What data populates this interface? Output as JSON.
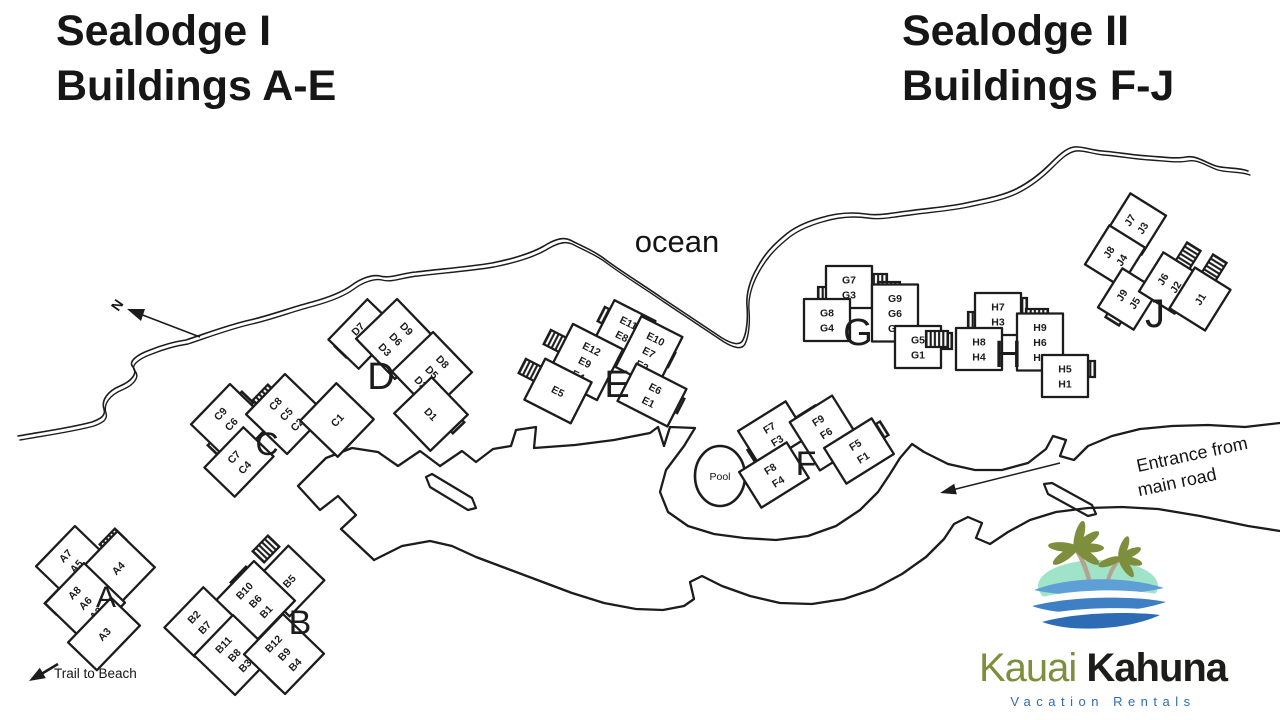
{
  "titles": {
    "left": {
      "line1": "Sealodge I",
      "line2": "Buildings A-E"
    },
    "right": {
      "line1": "Sealodge II",
      "line2": "Buildings F-J"
    }
  },
  "map_labels": {
    "ocean": "ocean",
    "pool": "Pool",
    "north": "N",
    "trail": "Trail to Beach",
    "entrance_line1": "Entrance from",
    "entrance_line2": "main road"
  },
  "logo": {
    "brand_primary": "Kauai",
    "brand_secondary": "Kahuna",
    "tagline": "Vacation Rentals"
  },
  "colors": {
    "ink": "#1c1c1c",
    "logo_green": "#7d8e3c",
    "logo_dark": "#1d1d1b",
    "logo_blue": "#2d6cb5",
    "wave_light": "#5e9fd6",
    "wave_mid": "#3f7fc4",
    "island_mint": "#9fe3c8",
    "trunk": "#b5a38c"
  },
  "map": {
    "buildings": [
      {
        "letter": "A",
        "lx": 106,
        "ly": 607,
        "ls": 30,
        "wings": [
          {
            "x": 76,
            "y": 566,
            "r": -46,
            "labels": [
              "A7",
              "A5",
              "A1"
            ]
          },
          {
            "x": 118,
            "y": 568,
            "r": -46,
            "labels": [
              "A4"
            ],
            "w": 52,
            "h": 52
          },
          {
            "x": 85,
            "y": 603,
            "r": -46,
            "labels": [
              "A8",
              "A6",
              "A2"
            ]
          },
          {
            "x": 104,
            "y": 634,
            "r": -46,
            "labels": [
              "A3"
            ],
            "w": 62,
            "h": 40
          }
        ],
        "stairs": [
          {
            "x": 73,
            "y": 546,
            "r": -46
          },
          {
            "x": 113,
            "y": 542,
            "r": -46
          },
          {
            "x": 58,
            "y": 601,
            "r": -46
          },
          {
            "x": 92,
            "y": 650,
            "r": -46
          }
        ]
      },
      {
        "letter": "B",
        "lx": 300,
        "ly": 634,
        "ls": 34,
        "wings": [
          {
            "x": 289,
            "y": 581,
            "r": -46,
            "labels": [
              "B5"
            ],
            "w": 50,
            "h": 50
          },
          {
            "x": 255,
            "y": 601,
            "r": -46,
            "labels": [
              "B10",
              "B6",
              "B1"
            ]
          },
          {
            "x": 199,
            "y": 622,
            "r": -46,
            "labels": [
              "B2",
              "B7"
            ]
          },
          {
            "x": 234,
            "y": 655,
            "r": -46,
            "labels": [
              "B11",
              "B8",
              "B3"
            ]
          },
          {
            "x": 284,
            "y": 654,
            "r": -46,
            "labels": [
              "B12",
              "B9",
              "B4"
            ]
          }
        ],
        "stairs": [
          {
            "x": 266,
            "y": 549,
            "r": -46
          },
          {
            "x": 244,
            "y": 580,
            "r": -46
          },
          {
            "x": 186,
            "y": 629,
            "r": -46
          },
          {
            "x": 231,
            "y": 674,
            "r": -46
          },
          {
            "x": 281,
            "y": 675,
            "r": -46
          }
        ]
      },
      {
        "letter": "C",
        "lx": 267,
        "ly": 455,
        "ls": 32,
        "wings": [
          {
            "x": 231,
            "y": 424,
            "r": -46,
            "labels": [
              "C9",
              "C6",
              "C3"
            ]
          },
          {
            "x": 286,
            "y": 414,
            "r": -46,
            "labels": [
              "C8",
              "C5",
              "C2"
            ]
          },
          {
            "x": 337,
            "y": 420,
            "r": -46,
            "labels": [
              "C1"
            ],
            "w": 52,
            "h": 52
          },
          {
            "x": 239,
            "y": 462,
            "r": -46,
            "labels": [
              "C7",
              "C4"
            ]
          }
        ],
        "stairs": [
          {
            "x": 240,
            "y": 405,
            "r": -46
          },
          {
            "x": 266,
            "y": 398,
            "r": -46
          },
          {
            "x": 338,
            "y": 403,
            "r": -46
          },
          {
            "x": 221,
            "y": 443,
            "r": -46
          }
        ]
      },
      {
        "letter": "D",
        "lx": 381,
        "ly": 389,
        "ls": 38,
        "wings": [
          {
            "x": 363,
            "y": 334,
            "r": -46,
            "labels": [
              "D7",
              "D4"
            ]
          },
          {
            "x": 396,
            "y": 339,
            "r": 46,
            "labels": [
              "D9",
              "D6",
              "D3"
            ]
          },
          {
            "x": 432,
            "y": 372,
            "r": 46,
            "labels": [
              "D8",
              "D5",
              "D2"
            ]
          },
          {
            "x": 431,
            "y": 414,
            "r": 46,
            "labels": [
              "D1"
            ],
            "w": 52,
            "h": 52
          }
        ],
        "stairs": [
          {
            "x": 348,
            "y": 344,
            "r": -46
          },
          {
            "x": 404,
            "y": 320,
            "r": 46
          },
          {
            "x": 449,
            "y": 364,
            "r": 46
          },
          {
            "x": 451,
            "y": 420,
            "r": 46
          }
        ]
      },
      {
        "letter": "E",
        "lx": 617,
        "ly": 397,
        "ls": 38,
        "wings": [
          {
            "x": 622,
            "y": 336,
            "r": 27,
            "labels": [
              "E11",
              "E8",
              "E3"
            ],
            "w": 46
          },
          {
            "x": 649,
            "y": 352,
            "r": 27,
            "labels": [
              "E10",
              "E7",
              "E2"
            ],
            "w": 46
          },
          {
            "x": 585,
            "y": 362,
            "r": 27,
            "labels": [
              "E12",
              "E9",
              "E4"
            ]
          },
          {
            "x": 558,
            "y": 391,
            "r": 27,
            "labels": [
              "E5"
            ],
            "w": 52,
            "h": 46
          },
          {
            "x": 652,
            "y": 395,
            "r": 27,
            "labels": [
              "E6",
              "E1"
            ]
          }
        ],
        "stairs": [
          {
            "x": 611,
            "y": 319,
            "r": 27
          },
          {
            "x": 557,
            "y": 342,
            "r": 27
          },
          {
            "x": 532,
            "y": 371,
            "r": 27
          },
          {
            "x": 662,
            "y": 355,
            "r": 27
          },
          {
            "x": 671,
            "y": 401,
            "r": 27
          }
        ]
      },
      {
        "letter": "F",
        "lx": 806,
        "ly": 475,
        "ls": 34,
        "wings": [
          {
            "x": 773,
            "y": 434,
            "r": -32,
            "labels": [
              "F7",
              "F3"
            ]
          },
          {
            "x": 826,
            "y": 433,
            "r": -32,
            "labels": [
              "F9",
              "F6",
              "F2"
            ],
            "w": 50
          },
          {
            "x": 859,
            "y": 451,
            "r": -32,
            "labels": [
              "F5",
              "F1"
            ]
          },
          {
            "x": 774,
            "y": 475,
            "r": -32,
            "labels": [
              "F8",
              "F4"
            ]
          }
        ],
        "stairs": [
          {
            "x": 784,
            "y": 420,
            "r": -32
          },
          {
            "x": 810,
            "y": 418,
            "r": -32
          },
          {
            "x": 875,
            "y": 434,
            "r": -32
          },
          {
            "x": 761,
            "y": 451,
            "r": -32
          }
        ]
      },
      {
        "letter": "G",
        "lx": 858,
        "ly": 345,
        "ls": 38,
        "wings": [
          {
            "x": 849,
            "y": 287,
            "r": 0,
            "labels": [
              "G7",
              "G3"
            ],
            "w": 46
          },
          {
            "x": 895,
            "y": 313,
            "r": 0,
            "labels": [
              "G9",
              "G6",
              "G2"
            ],
            "w": 46
          },
          {
            "x": 827,
            "y": 320,
            "r": 0,
            "labels": [
              "G8",
              "G4"
            ],
            "w": 46
          },
          {
            "x": 918,
            "y": 347,
            "r": 0,
            "labels": [
              "G5",
              "G1"
            ],
            "w": 46
          }
        ],
        "stairs": [
          {
            "x": 876,
            "y": 282,
            "r": 0
          },
          {
            "x": 889,
            "y": 290,
            "r": 0
          },
          {
            "x": 829,
            "y": 295,
            "r": 0
          },
          {
            "x": 941,
            "y": 341,
            "r": 0
          }
        ]
      },
      {
        "letter": "H",
        "lx": 1008,
        "ly": 367,
        "ls": 38,
        "wings": [
          {
            "x": 998,
            "y": 314,
            "r": 0,
            "labels": [
              "H7",
              "H3"
            ],
            "w": 46
          },
          {
            "x": 979,
            "y": 349,
            "r": 0,
            "labels": [
              "H8",
              "H4"
            ],
            "w": 46
          },
          {
            "x": 1040,
            "y": 342,
            "r": 0,
            "labels": [
              "H9",
              "H6",
              "H2"
            ],
            "w": 46
          },
          {
            "x": 1065,
            "y": 376,
            "r": 0,
            "labels": [
              "H5",
              "H1"
            ],
            "w": 46
          }
        ],
        "stairs": [
          {
            "x": 1016,
            "y": 306,
            "r": 0
          },
          {
            "x": 979,
            "y": 320,
            "r": 0
          },
          {
            "x": 1037,
            "y": 317,
            "r": 0
          },
          {
            "x": 1084,
            "y": 369,
            "r": 0
          },
          {
            "x": 937,
            "y": 339,
            "r": 0
          }
        ]
      },
      {
        "letter": "J",
        "lx": 1155,
        "ly": 327,
        "ls": 40,
        "wings": [
          {
            "x": 1136,
            "y": 224,
            "r": -58,
            "labels": [
              "J7",
              "J3"
            ],
            "w": 46
          },
          {
            "x": 1115,
            "y": 256,
            "r": -58,
            "labels": [
              "J8",
              "J4"
            ],
            "w": 46
          },
          {
            "x": 1128,
            "y": 299,
            "r": -58,
            "labels": [
              "J9",
              "J5"
            ],
            "w": 46
          },
          {
            "x": 1169,
            "y": 283,
            "r": -58,
            "labels": [
              "J6",
              "J2"
            ],
            "w": 46
          },
          {
            "x": 1200,
            "y": 299,
            "r": -58,
            "labels": [
              "J1"
            ],
            "w": 48,
            "h": 42
          }
        ],
        "stairs": [
          {
            "x": 1140,
            "y": 213,
            "r": -58
          },
          {
            "x": 1104,
            "y": 259,
            "r": -58
          },
          {
            "x": 1118,
            "y": 312,
            "r": -58
          },
          {
            "x": 1188,
            "y": 256,
            "r": -58
          },
          {
            "x": 1214,
            "y": 268,
            "r": -58
          }
        ]
      }
    ]
  }
}
